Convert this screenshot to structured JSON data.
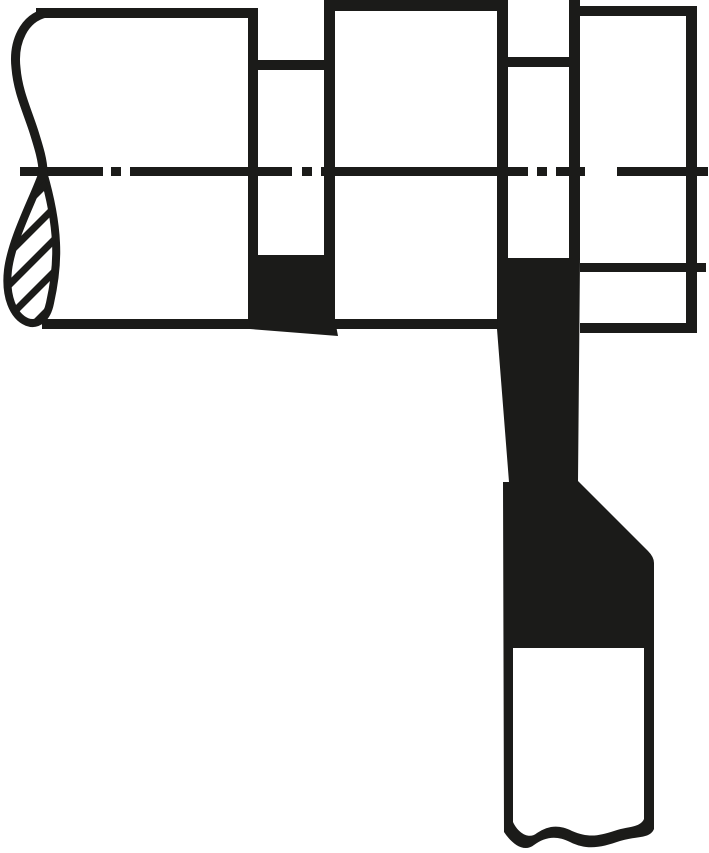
{
  "drawing": {
    "type": "technical-line-drawing",
    "subject": "Lathe parting tool plunge-cutting grooves in a stepped shaft",
    "parts": {
      "workpiece": "stepped-shaft-with-two-grooves",
      "left_end": "freehand-break-with-hatched-section",
      "axis": "dash-dot-centerline",
      "left_groove": "machined-groove-with-insert",
      "right_groove": "groove-being-cut",
      "tool": "parting-tool-black-insert-with-white-shank",
      "machined_line": "turned-diameter-line-extending-right"
    }
  },
  "colors": {
    "ink": "#1b1b19",
    "paper": "#ffffff"
  }
}
